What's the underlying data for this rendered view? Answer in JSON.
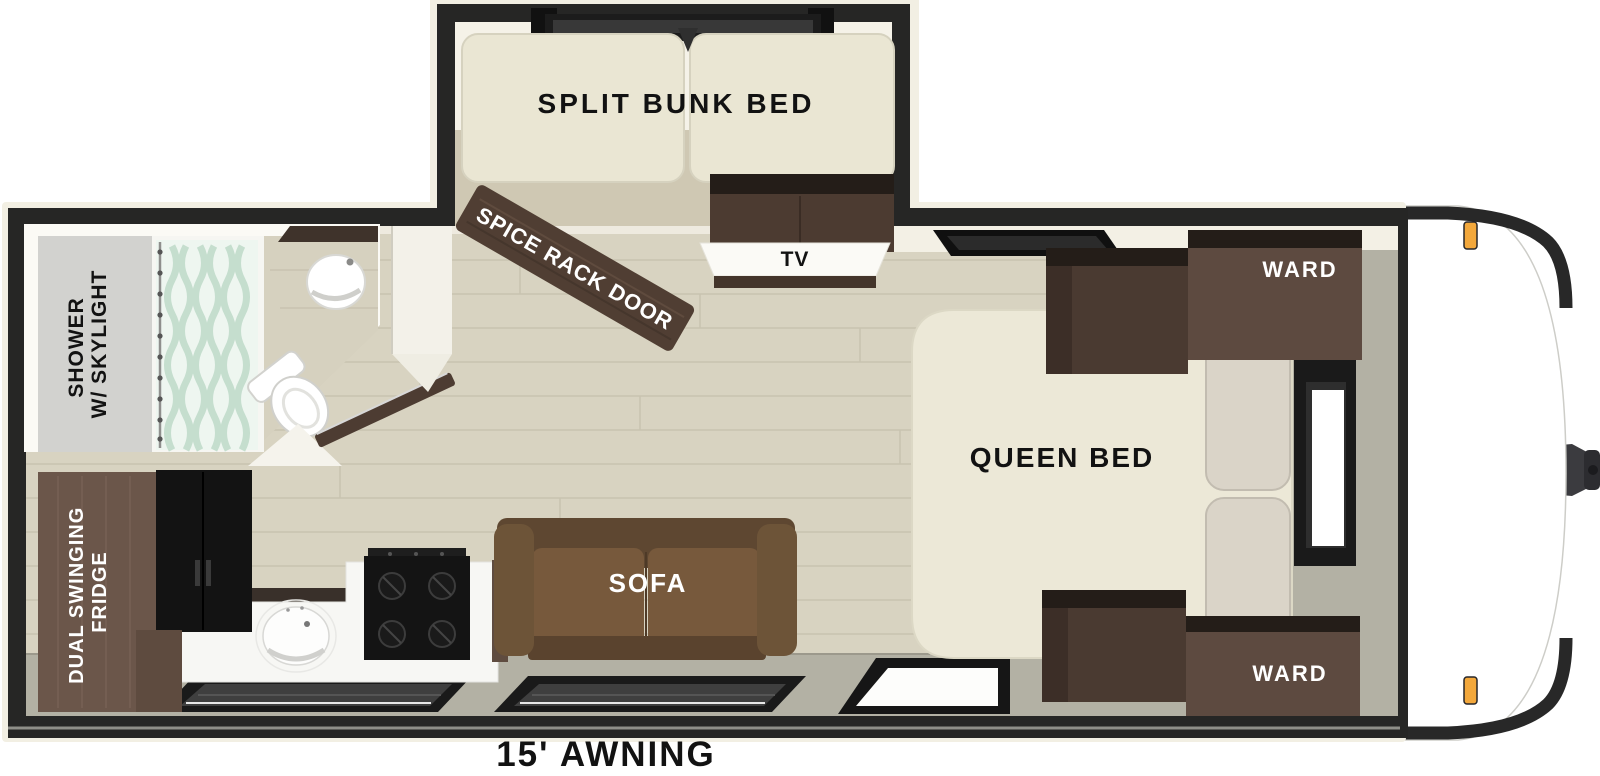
{
  "floorplan": {
    "bunk_room": {
      "label": "SPLIT BUNK BED"
    },
    "spice_rack_door": {
      "label": "SPICE RACK DOOR"
    },
    "entertainment": {
      "tv_label": "TV"
    },
    "bedroom": {
      "bed_label": "QUEEN BED",
      "wardrobe_top_label": "WARD",
      "wardrobe_bottom_label": "WARD"
    },
    "bathroom": {
      "shower_label_line1": "SHOWER",
      "shower_label_line2": "W/ SKYLIGHT"
    },
    "kitchen": {
      "fridge_label_line1": "DUAL SWINGING",
      "fridge_label_line2": "FRIDGE"
    },
    "living": {
      "sofa_label": "SOFA"
    },
    "exterior": {
      "awning_label": "15' AWNING"
    },
    "colors": {
      "wall": "#262625",
      "wood_floor": "#d8d3c1",
      "gray_floor": "#b3b1a4",
      "cabinet_brown": "#5d4a40",
      "mattress_cream": "#ece8d7",
      "sofa_brown": "#6d5438",
      "curtain_mint": "#c3ddcd",
      "marker_light_amber": "#f3a83c"
    }
  }
}
